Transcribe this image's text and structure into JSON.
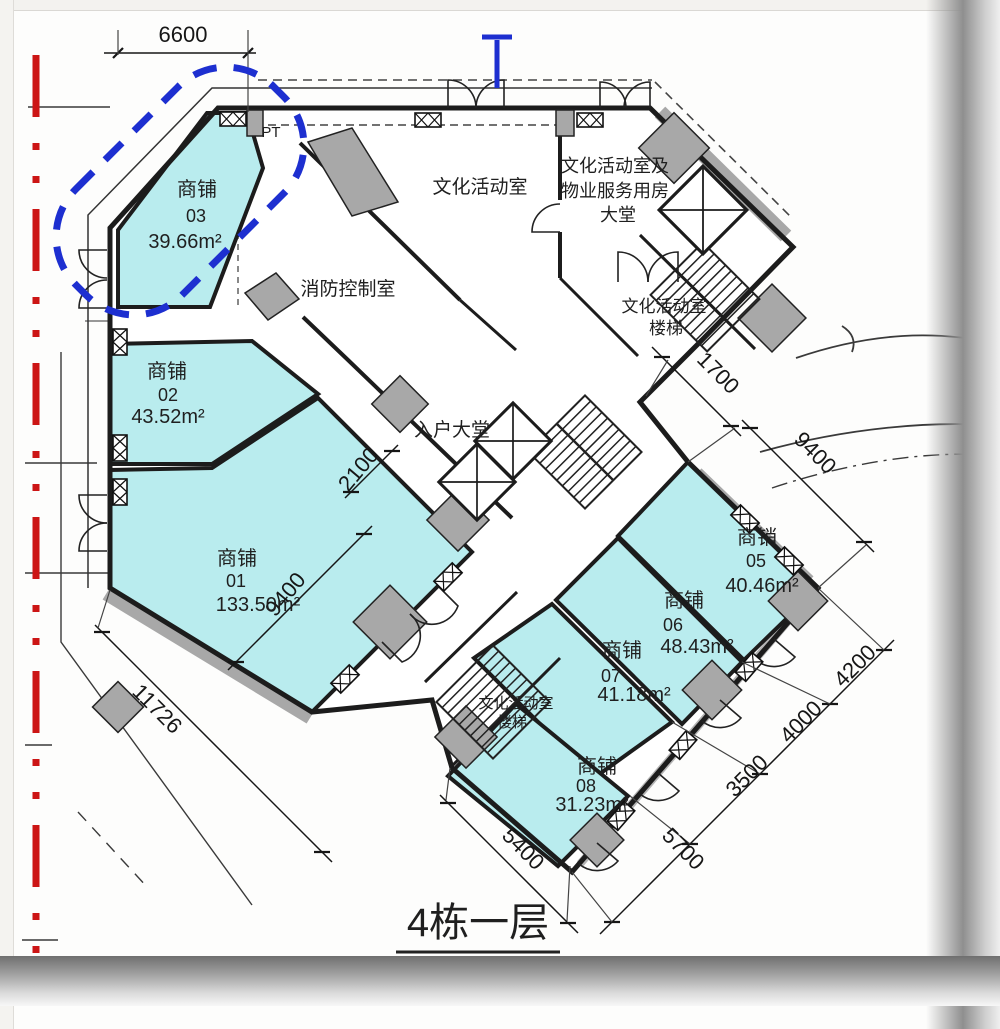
{
  "title": "4栋一层",
  "colors": {
    "shop_fill": "#b9ecee",
    "wall": "#1c1c1c",
    "column_gray": "#a8a8a8",
    "highlight_blue": "#1d2fd0",
    "boundary_red": "#cc1515"
  },
  "shops": [
    {
      "name": "商铺",
      "number": "03",
      "area": "39.66m²"
    },
    {
      "name": "商铺",
      "number": "02",
      "area": "43.52m²"
    },
    {
      "name": "商铺",
      "number": "01",
      "area": "133.50m²"
    },
    {
      "name": "商销",
      "number": "05",
      "area": "40.46m²"
    },
    {
      "name": "商铺",
      "number": "06",
      "area": "48.43m²"
    },
    {
      "name": "商铺",
      "number": "07",
      "area": "41.18m²"
    },
    {
      "name": "商铺",
      "number": "08",
      "area": "31.23m²"
    }
  ],
  "rooms": {
    "cultural_activity": "文化活动室",
    "lobby_line1": "文化活动室及",
    "lobby_line2": "物业服务用房",
    "lobby_line3": "大堂",
    "fire_control": "消防控制室",
    "entry_lobby": "入户大堂",
    "stair_ne_line1": "文化活动室",
    "stair_ne_line2": "楼梯",
    "stair_s_line1": "文化活动室",
    "stair_s_line2": "楼梯",
    "pt_label": "PT"
  },
  "dimensions": {
    "top": "6600",
    "ne_small": "1700",
    "ne_large": "9400",
    "corridor": "2100",
    "shop01_diagonal": "9400",
    "southwest": "11726",
    "south": "5400",
    "se_seg1": "5700",
    "se_seg2": "3500",
    "se_seg3": "4000",
    "se_seg4": "4200"
  }
}
